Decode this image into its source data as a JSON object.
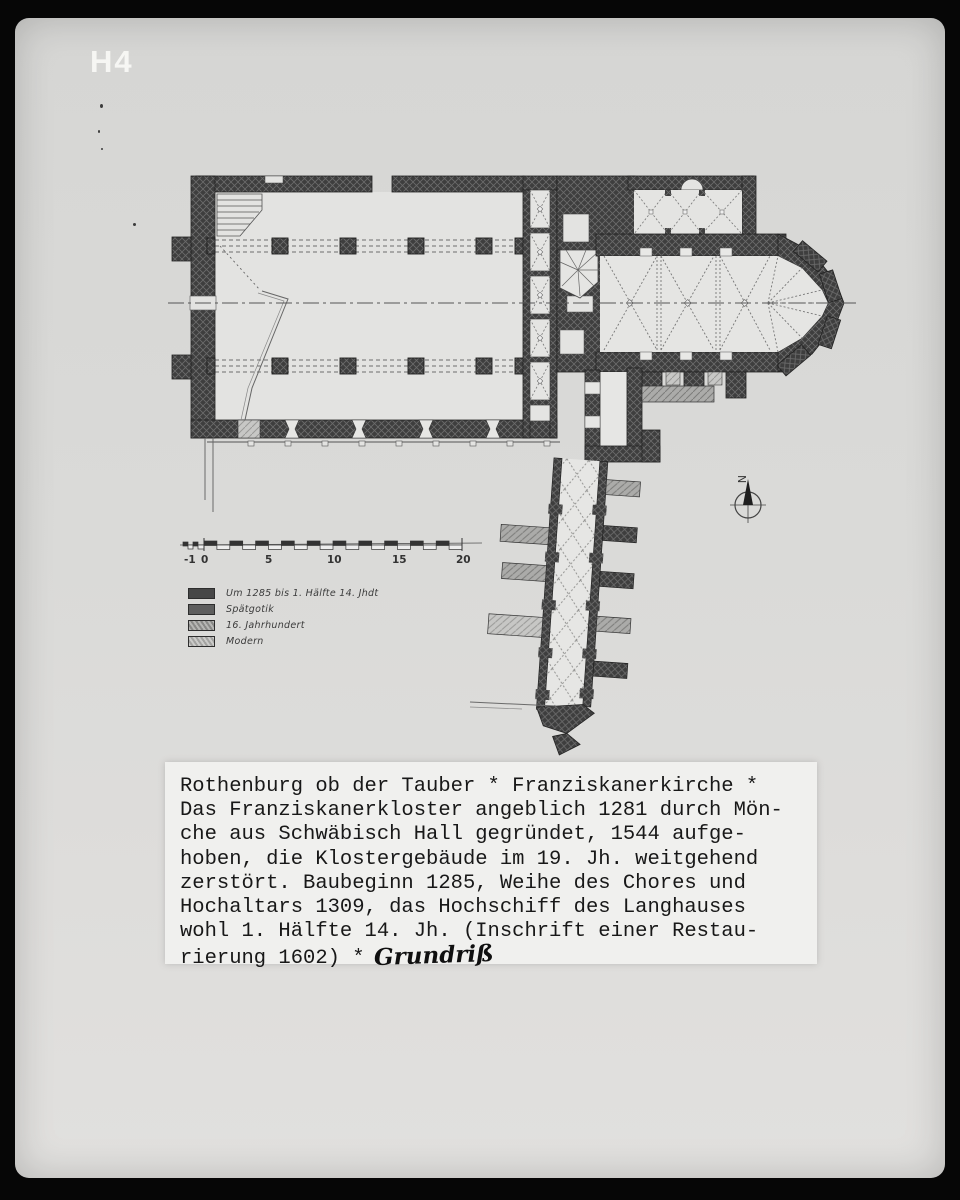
{
  "photo": {
    "corner_label": "H4",
    "background_color": "#dadad8",
    "frame_color": "#060606",
    "ink_color": "#3e3e3e"
  },
  "plan": {
    "subject": "floor plan of Franziskanerkirche Rothenburg ob der Tauber",
    "compass_label": "N"
  },
  "scale_bar": {
    "unit_labels": [
      "-1",
      "0",
      "5",
      "10",
      "15",
      "20"
    ]
  },
  "legend": {
    "items": [
      {
        "label": "Um 1285 bis 1. Hälfte 14. Jhdt",
        "swatch_color": "#474747",
        "style": "solid-dark-crosshatch"
      },
      {
        "label": "Spätgotik",
        "swatch_color": "#5e5e5e",
        "style": "solid-dark"
      },
      {
        "label": "16. Jahrhundert",
        "swatch_color": "#a9a9a7",
        "style": "hatched"
      },
      {
        "label": "Modern",
        "swatch_color": "#c7c7c5",
        "style": "hatched-light"
      }
    ]
  },
  "caption": {
    "lines": [
      "Rothenburg ob der Tauber * Franziskanerkirche *",
      "Das Franziskanerkloster angeblich 1281 durch Mön-",
      "che aus Schwäbisch Hall gegründet, 1544 aufge-",
      "hoben, die Klostergebäude im 19. Jh. weitgehend",
      "zerstört. Baubeginn 1285, Weihe des Chores und",
      "Hochaltars 1309, das Hochschiff des Langhauses",
      "wohl 1. Hälfte 14. Jh. (Inschrift einer Restau-",
      "rierung 1602) *"
    ],
    "handwritten_suffix": "Grundriß"
  }
}
